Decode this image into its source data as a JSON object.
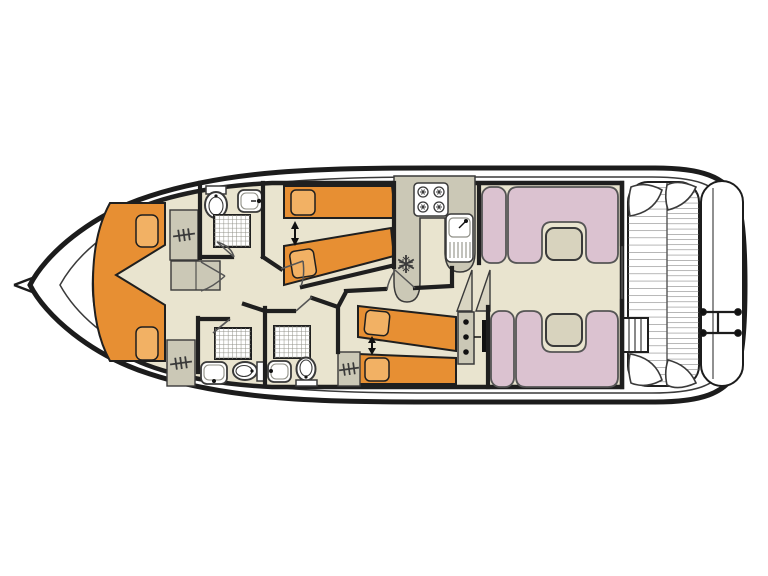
{
  "diagram": {
    "type": "boat-floor-plan",
    "orientation": "bow-left-stern-right",
    "areas": [
      "bow-cabin-v-berth",
      "forward-bathroom",
      "forward-twin-cabin",
      "galley",
      "saloon-dinette-upper",
      "saloon-dinette-lower",
      "aft-twin-cabin",
      "aft-bathroom-left",
      "aft-bathroom-right",
      "aft-deck",
      "swim-platform"
    ],
    "fixtures": [
      "v-berth-double-bed",
      "twin-beds-convertible",
      "double-arrow-icon",
      "wardrobe-icon",
      "shower-icon",
      "toilet-icon",
      "sink-icon",
      "stove-burners-icon",
      "galley-sink-drainer-icon",
      "snowflake-fridge-icon",
      "companionway-steps-icon",
      "drawer-cabinet-icon",
      "tv-icon",
      "deck-planks",
      "corner-seat",
      "deck-steps-icon",
      "stern-ladder-icon"
    ],
    "counts": {
      "cabins": 3,
      "bathrooms": 3,
      "dinettes": 2,
      "berths": 6
    }
  },
  "colors": {
    "outline": "#1c1c1c",
    "wall": "#1f1f1f",
    "hull_fill": "#ffffff",
    "floor": "#e9e4cf",
    "furniture": "#cbc8b6",
    "steps_fill": "#d9d5c2",
    "bed": "#e78f33",
    "pillow": "#f2b164",
    "seating": "#dbc2d0",
    "table": "#d8d3be",
    "fixture": "#ffffff",
    "line": "#3a3a3a",
    "thin": "#555555",
    "grid": "#8f8f86",
    "plank": "#707070",
    "dark": "#111111"
  }
}
